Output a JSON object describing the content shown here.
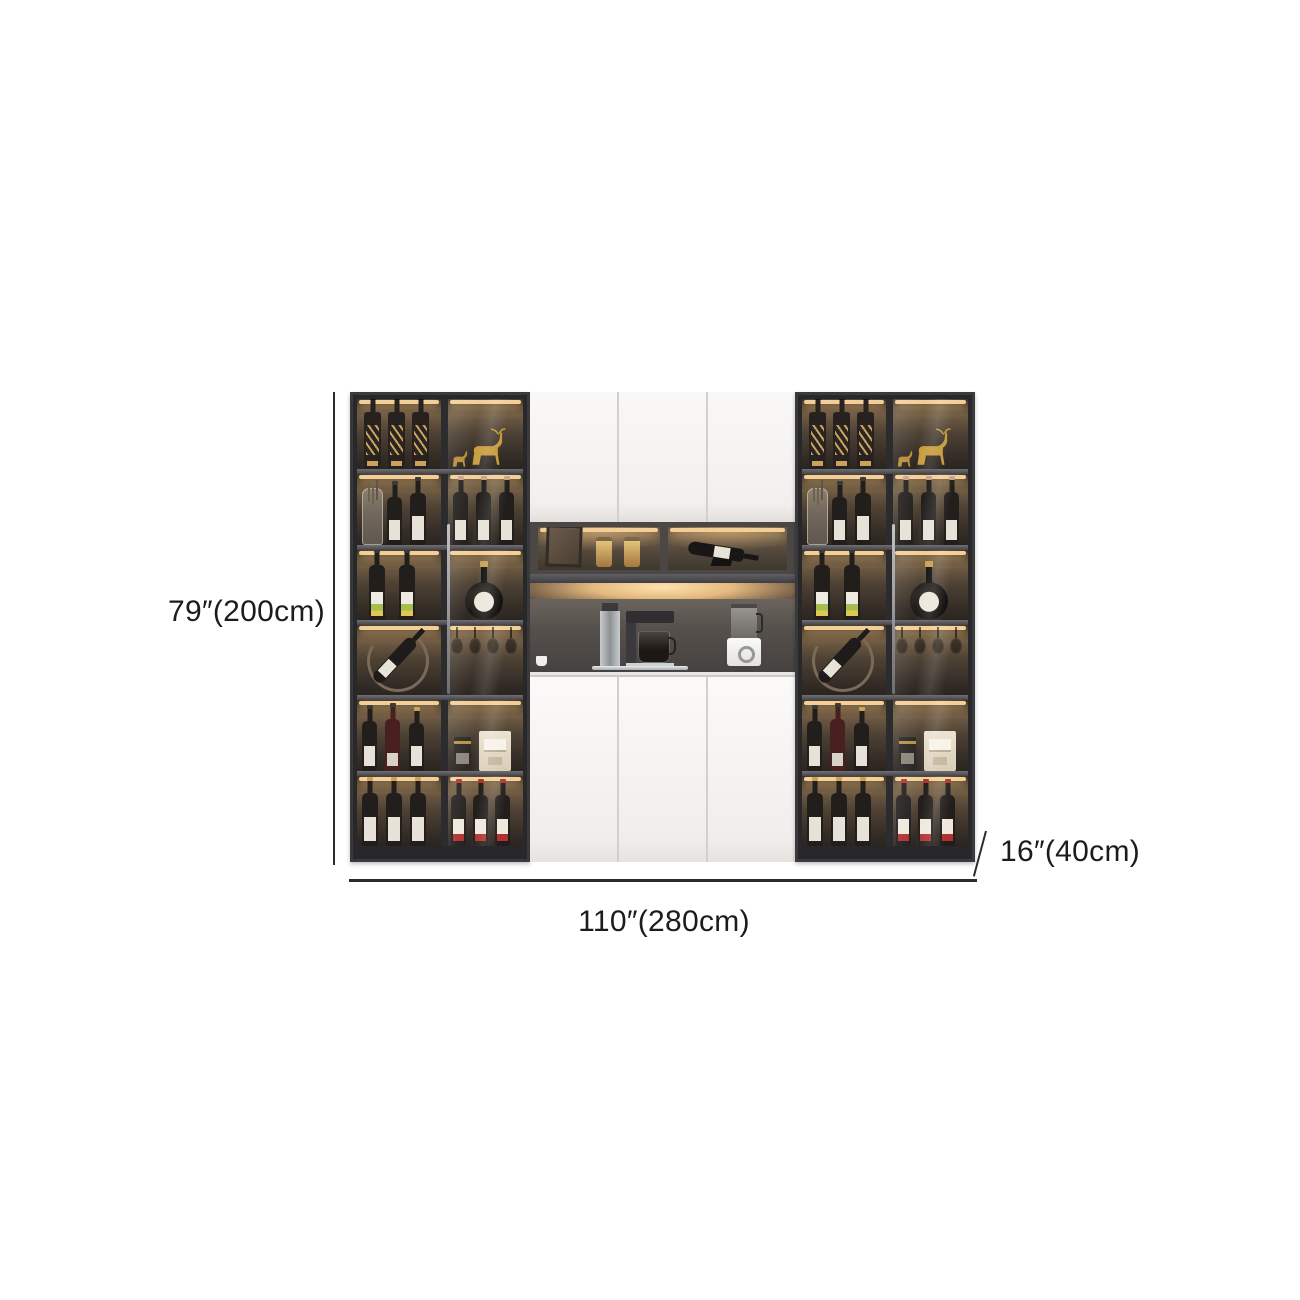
{
  "annotations": {
    "height": "79″(200cm)",
    "width": "110″(280cm)",
    "depth": "16″(40cm)"
  },
  "colors": {
    "background": "#ffffff",
    "dimension_line": "#2b2b2b",
    "dimension_text": "#1c1c1c",
    "cabinet_frame": "#28272a",
    "door_white": "#f6f5f3",
    "led_glow": "#f3cf97",
    "interior_wood": "#4e4234",
    "gold_accent": "#c9a359",
    "wine_red_accent": "#b23232"
  },
  "scene": {
    "items": [
      "whisky-bottle",
      "wine-bottle",
      "champagne-bottle",
      "liqueur-flask",
      "glass-decanter",
      "deer-figurine",
      "wine-rack",
      "wine-glass",
      "storage-jar",
      "picture-frame",
      "storage-canister",
      "gift-box",
      "coffee-grinder",
      "coffee-machine",
      "blender",
      "cup"
    ]
  }
}
